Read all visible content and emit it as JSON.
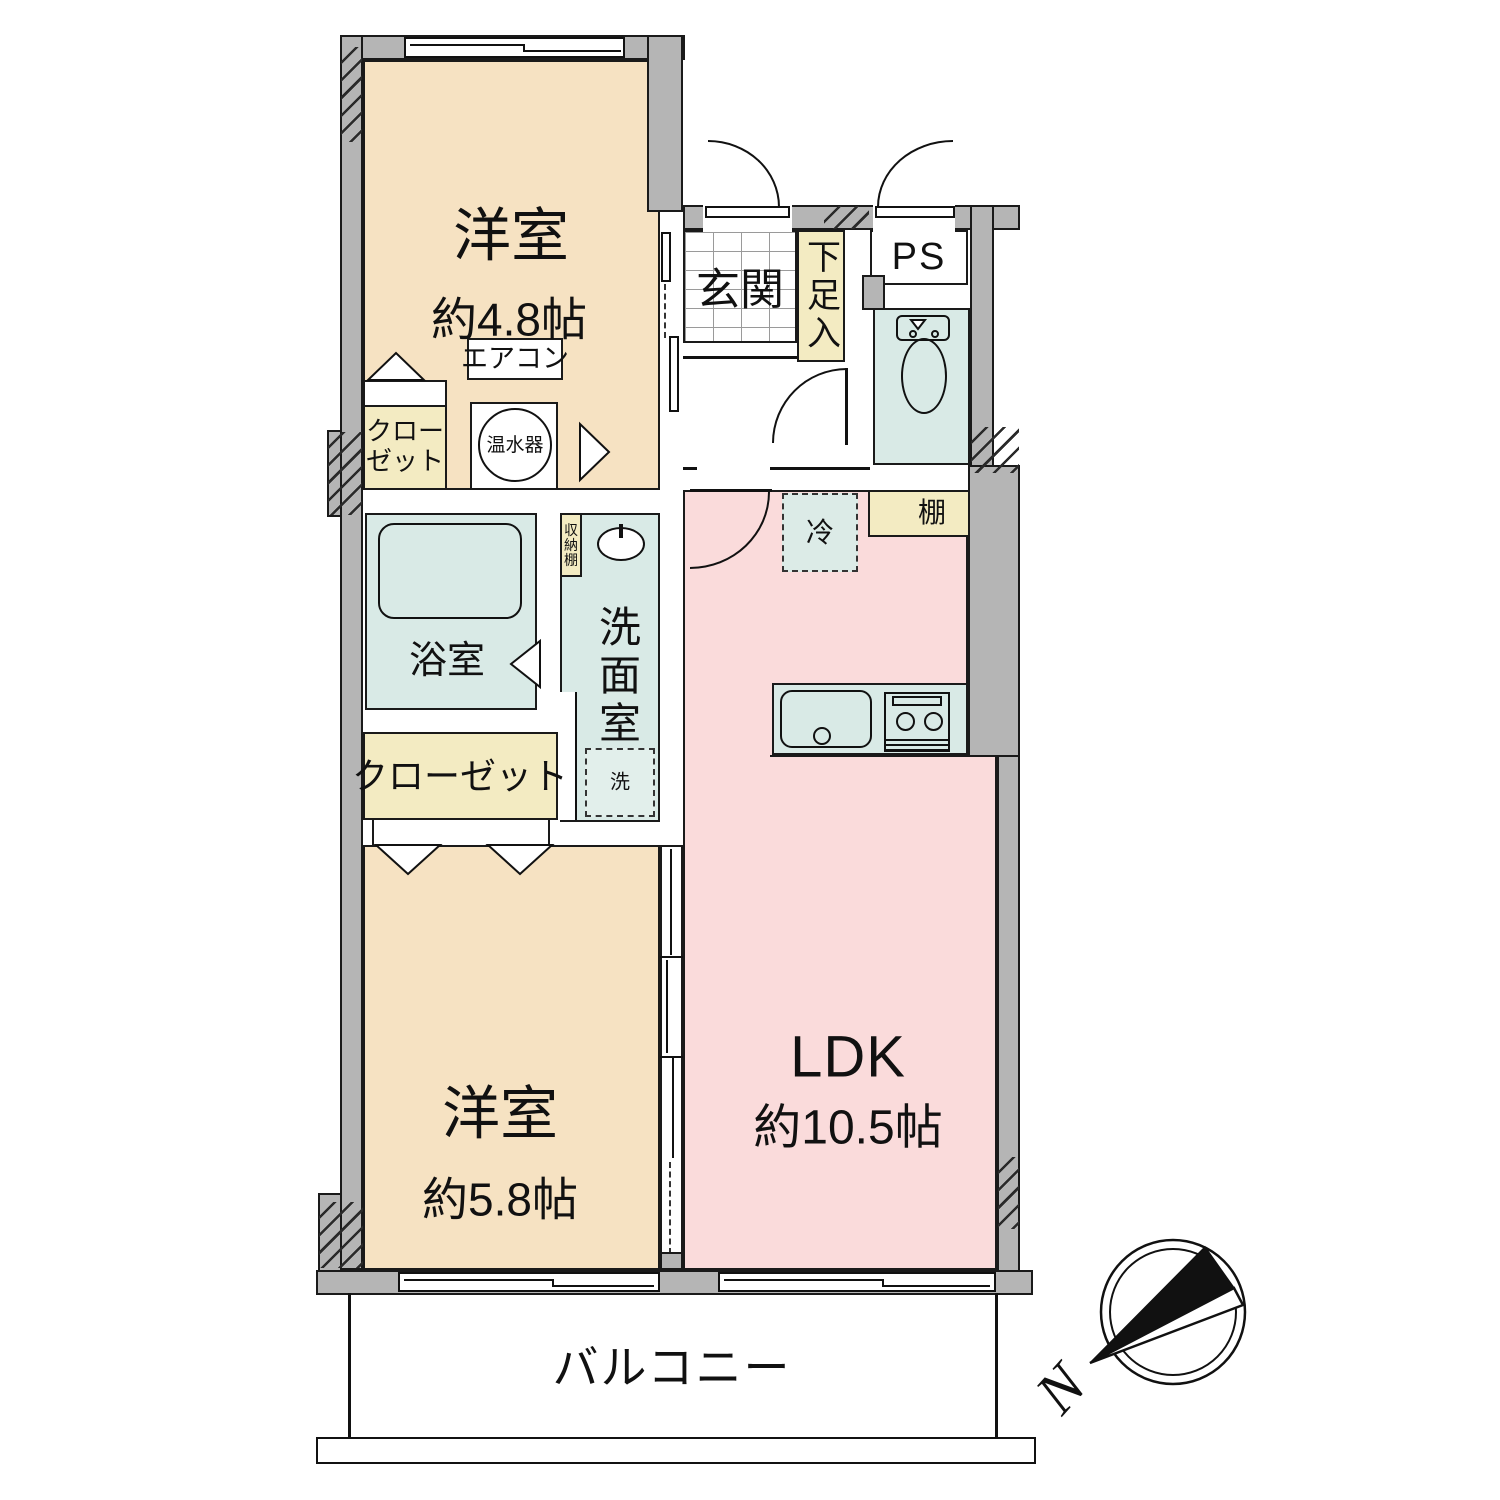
{
  "plan": {
    "room_west_1": {
      "name": "洋室",
      "size": "約4.8帖"
    },
    "room_west_2": {
      "name": "洋室",
      "size": "約5.8帖"
    },
    "ldk": {
      "name": "LDK",
      "size": "約10.5帖"
    },
    "entrance": "玄関",
    "shoe_cabinet": "下足入",
    "pipe_space": "PS",
    "air_conditioner": "エアコン",
    "closet_upper": {
      "line1": "クロー",
      "line2": "ゼット"
    },
    "water_heater": "温水器",
    "bathroom": "浴室",
    "storage_shelf": "収納棚",
    "washroom": "洗面室",
    "washing_machine": "洗",
    "refrigerator": "冷",
    "shelf": "棚",
    "closet_lower": "クローゼット",
    "balcony": "バルコニー"
  },
  "compass": {
    "north": "N"
  },
  "colors": {
    "wall": "#b5b5b5",
    "western_room": "#f6e2c2",
    "ldk": "#fadbdb",
    "wet_area": "#d9eae6",
    "storage": "#f3ebc2",
    "line": "#111111"
  }
}
